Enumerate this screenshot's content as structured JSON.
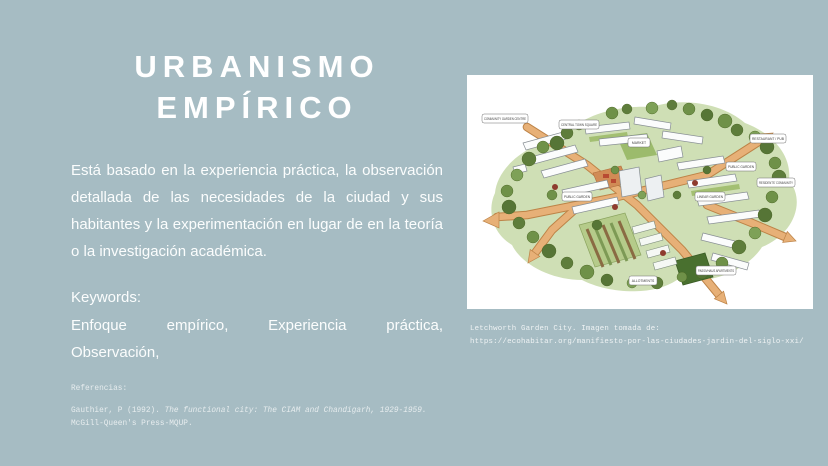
{
  "slide": {
    "background_color": "#a6bcc3",
    "text_color": "#ffffff",
    "title": "URBANISMO EMPÍRICO",
    "body": "Está basado en la experiencia práctica, la observación detallada de las necesidades de la ciudad y sus habitantes y la experimentación en lugar de en la teoría o la investigación académica.",
    "keywords": {
      "label": "Keywords:",
      "line1": "Enfoque empírico, Experiencia práctica,",
      "line2": "Observación,"
    },
    "references": {
      "label": "Referencias:",
      "author": "Gauthier, P (1992). ",
      "title": "The functional city: The CIAM and Chandigarh, 1929-1959.",
      "publisher": " McGill-Queen's Press-MQUP."
    }
  },
  "figure": {
    "subject": "Letchworth Garden City illustrated aerial view",
    "caption_line1": "Letchworth Garden City. Imagen tomada de:",
    "caption_line2": "https://ecohabitar.org/manifiesto-por-las-ciudades-jardin-del-siglo-xxi/",
    "labels": {
      "community_garden": "COMMUNITY GARDEN CENTRE",
      "town_square": "CENTRAL TOWN SQUARE",
      "market": "MARKET",
      "restaurant": "RESTAURANT / PUB",
      "public_garden_left": "PUBLIC GARDEN",
      "public_garden_right": "PUBLIC GARDEN",
      "linear_garden": "LINEAR GARDEN",
      "residents": "RESIDENTS' COMMUNITY",
      "allotments": "ALLOTMENTS",
      "passivhaus": "PASSIVHAUS APARTMENTS"
    },
    "colors": {
      "panel": "#ffffff",
      "field_green": "#cfdfb5",
      "tree_green": "#5e7d3b",
      "road_tan": "#e7b077",
      "building_gray": "#878e94"
    }
  }
}
